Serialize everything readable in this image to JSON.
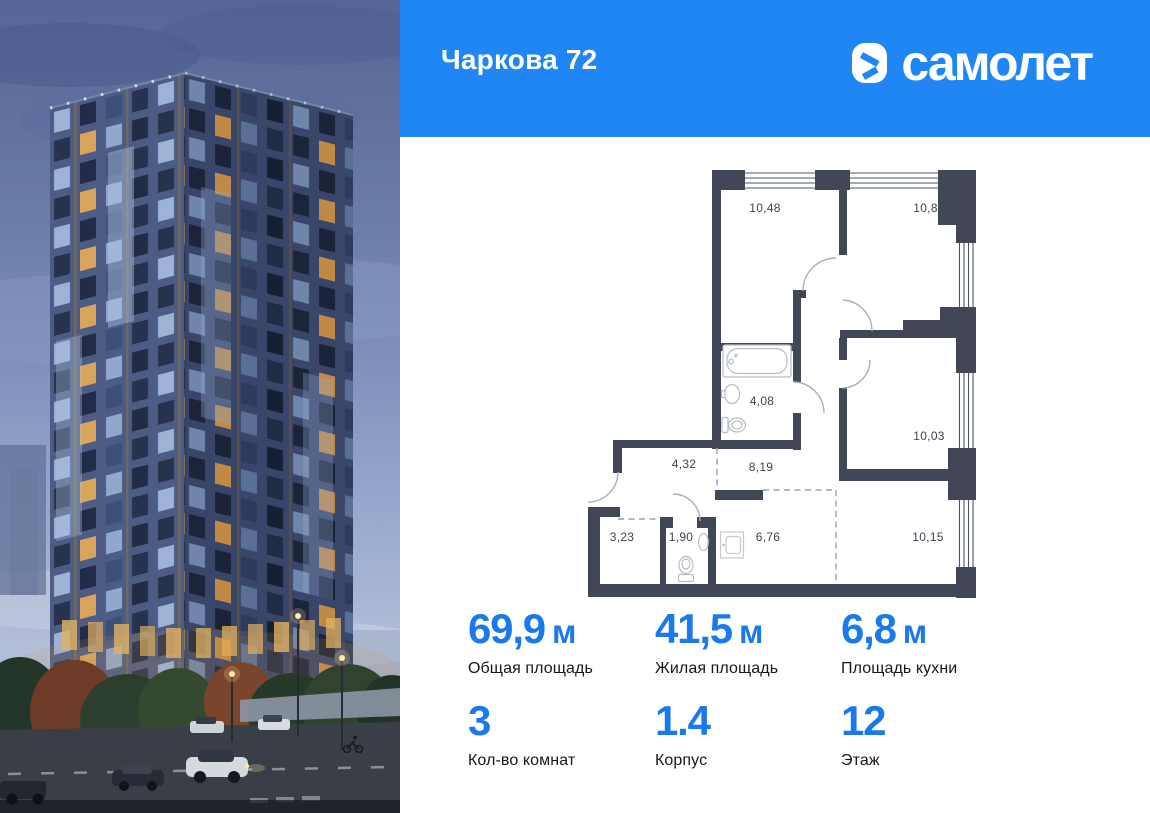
{
  "header": {
    "title": "Чаркова 72",
    "brand": "самолет",
    "brand_blue": "#1f86f3"
  },
  "floorplan": {
    "wall_color": "#414756",
    "label_color": "#3d4350",
    "areas": {
      "r10_48": "10,48",
      "r10_80": "10,80",
      "r4_08": "4,08",
      "r10_03": "10,03",
      "r4_32": "4,32",
      "r8_19": "8,19",
      "r3_23": "3,23",
      "r1_90": "1,90",
      "r6_76": "6,76",
      "r10_15": "10,15"
    }
  },
  "stats": {
    "value_color": "#1b79ee",
    "row1": [
      {
        "value": "69,9",
        "unit": "м",
        "label": "Общая площадь"
      },
      {
        "value": "41,5",
        "unit": "м",
        "label": "Жилая площадь"
      },
      {
        "value": "6,8",
        "unit": "м",
        "label": "Площадь кухни"
      }
    ],
    "row2": [
      {
        "value": "3",
        "label": "Кол-во комнат"
      },
      {
        "value": "1.4",
        "label": "Корпус"
      },
      {
        "value": "12",
        "label": "Этаж"
      }
    ]
  }
}
